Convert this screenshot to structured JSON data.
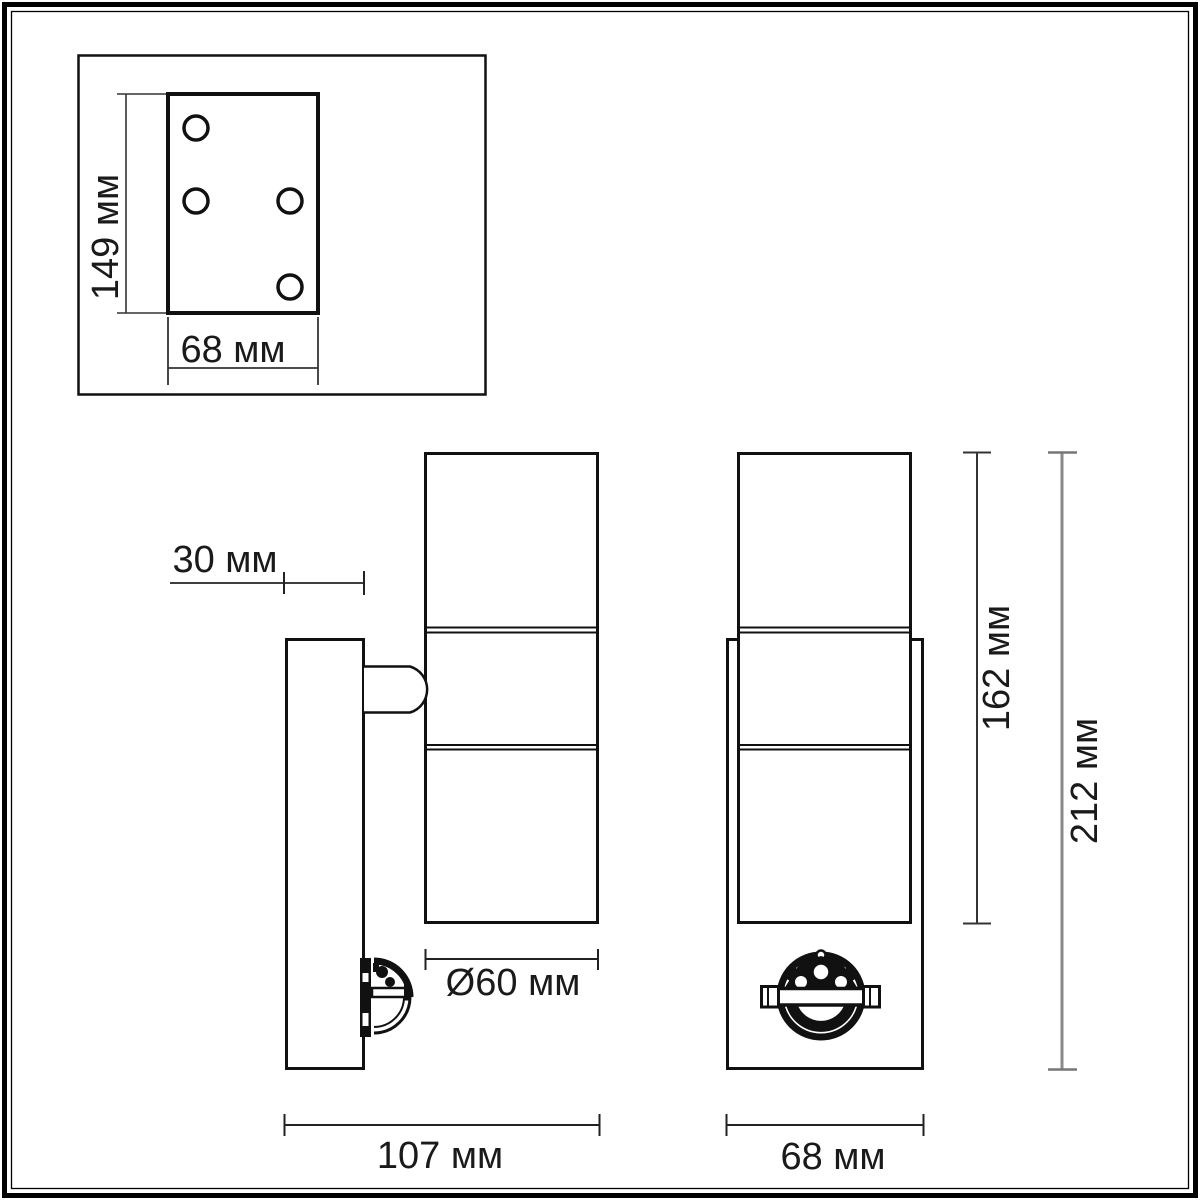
{
  "drawing": {
    "labels": {
      "plate_height": "149 мм",
      "plate_width": "68 мм",
      "wall_offset": "30 мм",
      "diameter": "Ø60 мм",
      "depth": "107 мм",
      "lamp_height": "162 мм",
      "total_height": "212 мм",
      "body_width": "68 мм"
    },
    "colors": {
      "line": "#1a1a1a",
      "dim_line": "#3a3a3a",
      "dim_line_light": "#8a8a8a",
      "background": "#ffffff"
    }
  }
}
